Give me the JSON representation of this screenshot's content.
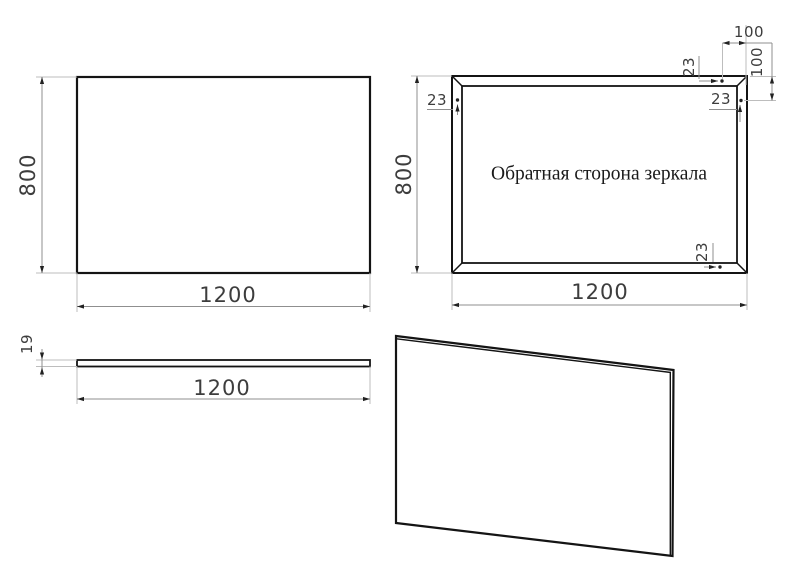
{
  "drawing": {
    "front_view": {
      "width": "1200",
      "height": "800"
    },
    "back_view": {
      "width": "1200",
      "height": "800",
      "label": "Обратная сторона зеркала",
      "hole_edge_offset": "23",
      "hole_corner_offset": "100"
    },
    "side_view": {
      "length": "1200",
      "thickness": "19"
    },
    "colors": {
      "outline": "#141414",
      "dimension_line": "#8f8f8f",
      "extension_line": "#bdbdbd",
      "dimension_text": "#3d3d3d",
      "label_text": "#1a1a1a",
      "background": "#ffffff"
    }
  }
}
